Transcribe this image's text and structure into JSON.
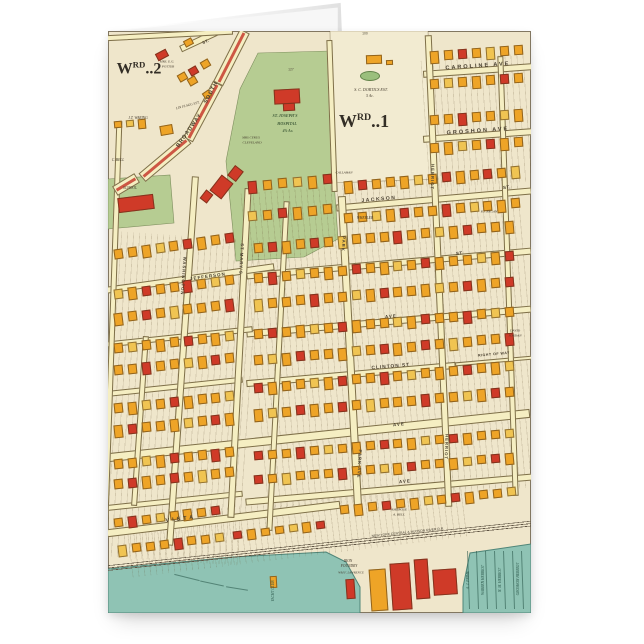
{
  "page": {
    "background": "#ffffff"
  },
  "card": {
    "description": "folded greeting card, portrait, fold at top",
    "front_print": "antique plat map"
  },
  "map": {
    "width": 423,
    "height": 582,
    "colors": {
      "base": "#efe6cb",
      "street": "#f5eec2",
      "green": "#b6cc92",
      "pond": "#9bbf7c",
      "water": "#8fc3b4",
      "water_edge": "#4f8578",
      "estate": "#f2ebd1",
      "broadway_stripe": "#cd5744",
      "building": {
        "o": "#eea427",
        "r": "#cf3a28",
        "y": "#f0c452"
      }
    },
    "building_palette": "ooroyooorooyoroooyor",
    "areas": [
      {
        "name": "dortics-estate",
        "points": "222,0 320,0 326,148 224,152",
        "fill": "#f2ebd1",
        "stroke": "rgba(105,88,52,.6)",
        "sw": 0.6
      },
      {
        "name": "hospital-grounds-green",
        "points": "150,22 222,20 226,150 230,208 196,226 128,230 118,130 132,58",
        "fill": "#b6cc92",
        "stroke": "rgba(90,110,60,.7)",
        "sw": 0.6
      },
      {
        "name": "school-green",
        "points": "0,148 62,144 66,192 0,198",
        "fill": "#b6cc92",
        "stroke": "rgba(90,110,60,.7)",
        "sw": 0.6
      },
      {
        "name": "river-water",
        "points": "0,538 125,526 218,521 238,531 252,556 252,582 0,582",
        "fill": "#8fc3b4",
        "stroke": "#4f8578",
        "sw": 1
      },
      {
        "name": "harbor-water",
        "points": "355,582 355,556 362,522 423,513 423,582",
        "fill": "#8fc3b4",
        "stroke": "#4f8578",
        "sw": 1
      }
    ],
    "pond": {
      "x": 252,
      "y": 40,
      "w": 18,
      "h": 8
    },
    "textures": [
      [
        317,
        26,
        106,
        128,
        -4
      ],
      [
        146,
        150,
        277,
        318,
        -5
      ],
      [
        2,
        205,
        140,
        325,
        4
      ],
      [
        20,
        468,
        340,
        58,
        -7
      ]
    ],
    "streets": [
      {
        "name": "caroline-ave",
        "x": 370,
        "y": 39,
        "l": 110,
        "t": 7,
        "r": -4
      },
      {
        "name": "groshon-ave",
        "x": 370,
        "y": 104,
        "l": 110,
        "t": 7,
        "r": -4
      },
      {
        "name": "jackson-st",
        "x": 326,
        "y": 168,
        "l": 196,
        "t": 7,
        "r": -5
      },
      {
        "name": "cross-st-1",
        "x": 281,
        "y": 232,
        "l": 286,
        "t": 7,
        "r": -5
      },
      {
        "name": "ave-1",
        "x": 281,
        "y": 290,
        "l": 286,
        "t": 7,
        "r": -5
      },
      {
        "name": "clinton-st",
        "x": 243,
        "y": 343,
        "l": 210,
        "t": 7,
        "r": -5
      },
      {
        "name": "right-of-way",
        "x": 386,
        "y": 330,
        "l": 78,
        "t": 4,
        "r": -5
      },
      {
        "name": "ave-2",
        "x": 211,
        "y": 404,
        "l": 424,
        "t": 9,
        "r": -6
      },
      {
        "name": "ave-3",
        "x": 281,
        "y": 458,
        "l": 288,
        "t": 7,
        "r": -5
      },
      {
        "name": "ave-3-west",
        "x": 65,
        "y": 470,
        "l": 140,
        "t": 6,
        "r": -6
      },
      {
        "name": "vista-ave",
        "x": 115,
        "y": 488,
        "l": 235,
        "t": 8,
        "r": -7
      },
      {
        "name": "jefferson-st",
        "x": 82,
        "y": 247,
        "l": 170,
        "t": 7,
        "r": -8
      },
      {
        "name": "west-st-1",
        "x": 70,
        "y": 306,
        "l": 150,
        "t": 6,
        "r": -6
      },
      {
        "name": "west-st-2",
        "x": 65,
        "y": 356,
        "l": 140,
        "t": 6,
        "r": -6
      },
      {
        "name": "washington-st",
        "x": 74,
        "y": 330,
        "l": 370,
        "t": 7,
        "r": 4,
        "v": 1
      },
      {
        "name": "st-marys-st",
        "x": 131,
        "y": 322,
        "l": 330,
        "t": 7,
        "r": 3,
        "v": 1
      },
      {
        "name": "park-ave",
        "x": 242,
        "y": 322,
        "l": 315,
        "t": 8,
        "r": -3,
        "v": 1
      },
      {
        "name": "herriot-st",
        "x": 330,
        "y": 240,
        "l": 472,
        "t": 7,
        "r": -2.5,
        "v": 1
      },
      {
        "name": "east-st",
        "x": 400,
        "y": 245,
        "l": 440,
        "t": 6,
        "r": -2,
        "v": 1
      },
      {
        "name": "left-edge-st",
        "x": 3,
        "y": 330,
        "l": 480,
        "t": 6,
        "r": 2,
        "v": 1
      },
      {
        "name": "mid-st",
        "x": 170,
        "y": 335,
        "l": 330,
        "t": 6,
        "r": 3,
        "v": 1
      },
      {
        "name": "west-short-st",
        "x": 32,
        "y": 390,
        "l": 170,
        "t": 6,
        "r": 4,
        "v": 1
      },
      {
        "name": "estate-west-st",
        "x": 224,
        "y": 85,
        "l": 152,
        "t": 6,
        "r": -2,
        "v": 1
      },
      {
        "name": "top-st",
        "x": 97,
        "y": 6,
        "l": 55,
        "t": 7,
        "r": -25
      },
      {
        "name": "top-edge-st",
        "x": 60,
        "y": 4,
        "l": 130,
        "t": 6,
        "r": -3
      },
      {
        "name": "broadway-1",
        "x": 123,
        "y": 26,
        "l": 59,
        "t": 11,
        "r": 117,
        "s": 1
      },
      {
        "name": "broadway-2",
        "x": 95,
        "y": 80,
        "l": 64,
        "t": 11,
        "r": 118,
        "s": 1
      },
      {
        "name": "broadway-3",
        "x": 57,
        "y": 127,
        "l": 60,
        "t": 11,
        "r": 140,
        "s": 1
      },
      {
        "name": "broadway-4",
        "x": 18,
        "y": 153,
        "l": 26,
        "t": 11,
        "r": 149,
        "s": 1
      }
    ],
    "railroad": {
      "x": 212,
      "y": 515,
      "l": 430,
      "t": 6,
      "r": -6
    },
    "building_rows": [
      [
        322,
        20,
        7,
        14,
        9,
        10,
        -4
      ],
      [
        322,
        48,
        7,
        14,
        9,
        10,
        -4
      ],
      [
        322,
        84,
        7,
        14,
        9,
        10,
        -4
      ],
      [
        322,
        112,
        7,
        14,
        9,
        10,
        -4
      ],
      [
        236,
        150,
        13,
        14,
        9,
        10,
        -5
      ],
      [
        236,
        182,
        13,
        14,
        9,
        10,
        -5
      ],
      [
        146,
        212,
        19,
        14,
        9,
        10,
        -5
      ],
      [
        146,
        242,
        19,
        14,
        9,
        10,
        -5
      ],
      [
        146,
        268,
        19,
        14,
        9,
        10,
        -5
      ],
      [
        146,
        298,
        19,
        14,
        9,
        10,
        -5
      ],
      [
        146,
        324,
        19,
        14,
        9,
        10,
        -5
      ],
      [
        146,
        352,
        19,
        14,
        9,
        10,
        -5
      ],
      [
        146,
        378,
        19,
        14,
        9,
        10,
        -5
      ],
      [
        146,
        420,
        19,
        14,
        9,
        9,
        -5
      ],
      [
        146,
        444,
        19,
        14,
        9,
        9,
        -5
      ],
      [
        232,
        474,
        13,
        14,
        9,
        9,
        -6
      ],
      [
        140,
        150,
        6,
        15,
        9,
        10,
        -5
      ],
      [
        140,
        180,
        6,
        15,
        9,
        10,
        -5
      ],
      [
        6,
        218,
        9,
        14,
        9,
        10,
        -8
      ],
      [
        6,
        258,
        9,
        14,
        9,
        10,
        -7
      ],
      [
        6,
        282,
        9,
        14,
        9,
        10,
        -7
      ],
      [
        6,
        312,
        9,
        14,
        9,
        10,
        -6
      ],
      [
        6,
        334,
        9,
        14,
        9,
        10,
        -6
      ],
      [
        6,
        372,
        9,
        14,
        9,
        10,
        -6
      ],
      [
        6,
        394,
        9,
        14,
        9,
        10,
        -6
      ],
      [
        6,
        428,
        9,
        14,
        9,
        10,
        -6
      ],
      [
        6,
        448,
        9,
        14,
        9,
        10,
        -6
      ],
      [
        6,
        487,
        8,
        14,
        9,
        9,
        -7
      ],
      [
        10,
        514,
        8,
        14,
        9,
        9,
        -7
      ],
      [
        70,
        42,
        3,
        13,
        9,
        8,
        -30
      ],
      [
        6,
        90,
        3,
        12,
        8,
        7,
        -5
      ],
      [
        125,
        500,
        7,
        14,
        9,
        8,
        -7
      ]
    ],
    "building_singles": [
      [
        48,
        20,
        12,
        8,
        -28,
        "r"
      ],
      [
        76,
        8,
        9,
        7,
        -28,
        "o"
      ],
      [
        80,
        46,
        9,
        8,
        -30,
        "o"
      ],
      [
        52,
        94,
        13,
        10,
        -10,
        "o"
      ],
      [
        95,
        60,
        8,
        7,
        -35,
        "o"
      ],
      [
        166,
        58,
        26,
        15,
        -3,
        "r"
      ],
      [
        175,
        72,
        12,
        8,
        -3,
        "r"
      ],
      [
        10,
        165,
        36,
        15,
        -7,
        "r"
      ],
      [
        106,
        146,
        15,
        20,
        38,
        "r"
      ],
      [
        122,
        136,
        11,
        13,
        38,
        "r"
      ],
      [
        94,
        160,
        9,
        11,
        38,
        "r"
      ],
      [
        258,
        24,
        16,
        9,
        -2,
        "o"
      ],
      [
        278,
        29,
        7,
        5,
        -2,
        "o"
      ],
      [
        262,
        538,
        17,
        42,
        -4,
        "o"
      ],
      [
        283,
        532,
        20,
        47,
        -4,
        "r"
      ],
      [
        307,
        528,
        14,
        40,
        -4,
        "r"
      ],
      [
        325,
        538,
        24,
        26,
        -4,
        "r"
      ],
      [
        238,
        548,
        9,
        20,
        -4,
        "r"
      ],
      [
        162,
        545,
        7,
        12,
        -3,
        "o"
      ]
    ],
    "water_lines": {
      "grid": {
        "x0": 360,
        "step": 9,
        "count": 7,
        "y": 520,
        "len": 58,
        "rot": -2
      },
      "piers": [
        [
          66,
          546,
          26,
          14
        ],
        [
          92,
          552,
          24,
          12
        ],
        [
          118,
          557,
          22,
          9
        ]
      ]
    },
    "water_names": [
      {
        "text": "A. J. PRIME",
        "x": 361,
        "y": 549
      },
      {
        "text": "WARREN HERRIOT",
        "x": 376,
        "y": 549
      },
      {
        "text": "N. M. HERRIOT",
        "x": 393,
        "y": 549
      },
      {
        "text": "GROSHON HERRIOT",
        "x": 411,
        "y": 548
      },
      {
        "text": "YACHT CLUB",
        "x": 166,
        "y": 560
      }
    ],
    "labels": [
      {
        "t": "CAROLINE  AVE",
        "x": 370,
        "y": 36,
        "s": 5.5,
        "r": -4,
        "ls": 2,
        "k": "street"
      },
      {
        "t": "GROSHON  AVE",
        "x": 370,
        "y": 101,
        "s": 5.5,
        "r": -4,
        "ls": 2,
        "k": "street"
      },
      {
        "t": "JACKSON",
        "x": 271,
        "y": 169,
        "s": 5,
        "r": -5,
        "ls": 1.5,
        "k": "street"
      },
      {
        "t": "ST.",
        "x": 399,
        "y": 157,
        "s": 4.5,
        "r": -5,
        "ls": 0.5,
        "k": "street"
      },
      {
        "t": "ST.",
        "x": 352,
        "y": 223,
        "s": 4.5,
        "r": -5,
        "ls": 0.5,
        "k": "street"
      },
      {
        "t": "AVE",
        "x": 283,
        "y": 286,
        "s": 4.5,
        "r": -5,
        "ls": 1,
        "k": "street"
      },
      {
        "t": "CLINTON  ST",
        "x": 283,
        "y": 337,
        "s": 4.8,
        "r": -5,
        "ls": 1,
        "k": "street"
      },
      {
        "t": "RIGHT OF WAY",
        "x": 386,
        "y": 324,
        "s": 3.6,
        "r": -5,
        "ls": 0.5,
        "k": "street"
      },
      {
        "t": "AVE",
        "x": 291,
        "y": 394,
        "s": 4.5,
        "r": -6,
        "ls": 1,
        "k": "street"
      },
      {
        "t": "AVE",
        "x": 297,
        "y": 451,
        "s": 4.5,
        "r": -5,
        "ls": 1,
        "k": "street"
      },
      {
        "t": "VISTA",
        "x": 73,
        "y": 489,
        "s": 5.5,
        "r": -7,
        "ls": 3,
        "k": "street"
      },
      {
        "t": "JEFFERSON",
        "x": 100,
        "y": 246,
        "s": 4.5,
        "r": -8,
        "ls": 1,
        "k": "street"
      },
      {
        "t": "SOUTH",
        "x": 104,
        "y": 62,
        "s": 5.5,
        "r": -62,
        "ls": 1,
        "k": "street"
      },
      {
        "t": "BROADWAY",
        "x": 82,
        "y": 100,
        "s": 5.5,
        "r": -55,
        "ls": 1,
        "k": "street"
      },
      {
        "t": "ST.",
        "x": 98,
        "y": 11,
        "s": 4.2,
        "r": -22,
        "ls": 0.5,
        "k": "street"
      },
      {
        "t": "WASHINGTON",
        "x": 75,
        "y": 245,
        "s": 4.2,
        "r": 94,
        "ls": 1,
        "k": "street"
      },
      {
        "t": "ST MARY'S",
        "x": 133,
        "y": 228,
        "s": 4.2,
        "r": 93,
        "ls": 1,
        "k": "street"
      },
      {
        "t": "PARK",
        "x": 235,
        "y": 213,
        "s": 4.2,
        "r": 93,
        "ls": 1,
        "k": "street"
      },
      {
        "t": "PARK  AVE",
        "x": 251,
        "y": 433,
        "s": 4.2,
        "r": 93,
        "ls": 1,
        "k": "street"
      },
      {
        "t": "HERRIOT",
        "x": 324,
        "y": 146,
        "s": 4.2,
        "r": 92,
        "ls": 1,
        "k": "street"
      },
      {
        "t": "HERRIOT",
        "x": 338,
        "y": 416,
        "s": 4.2,
        "r": 92,
        "ls": 1,
        "k": "street"
      },
      {
        "t": "W",
        "sup": "RD",
        "tail": "..2",
        "x": 31,
        "y": 38,
        "s": 16,
        "r": 0,
        "k": "ward"
      },
      {
        "t": "W",
        "sup": "RD",
        "tail": "..1",
        "x": 256,
        "y": 90,
        "s": 18,
        "r": 0,
        "k": "ward"
      },
      {
        "t": "ST. JOSEPH'S",
        "x": 177,
        "y": 85,
        "s": 4,
        "r": 0,
        "k": "green"
      },
      {
        "t": "HOSPITAL",
        "x": 179,
        "y": 93,
        "s": 4,
        "r": 0,
        "k": "green"
      },
      {
        "t": "4⅞ Ac.",
        "x": 180,
        "y": 101,
        "s": 3.8,
        "r": 0,
        "k": "green"
      },
      {
        "t": "S. C. DORTICS EST.",
        "x": 263,
        "y": 59,
        "s": 4,
        "r": 0,
        "k": "owner"
      },
      {
        "t": "5 Ac.",
        "x": 262,
        "y": 66,
        "s": 3.8,
        "r": 0,
        "k": "owner"
      },
      {
        "t": "MRS. E.G.",
        "x": 59,
        "y": 31,
        "s": 3.4,
        "r": 0,
        "k": "owner"
      },
      {
        "t": "POTTER",
        "x": 60,
        "y": 36,
        "s": 3.4,
        "r": 0,
        "k": "owner"
      },
      {
        "t": "J.T. WARING",
        "x": 30,
        "y": 88,
        "s": 3.6,
        "r": 0,
        "k": "owner"
      },
      {
        "t": "LIN FLAGG EST.",
        "x": 80,
        "y": 75,
        "s": 3.4,
        "r": -15,
        "k": "owner"
      },
      {
        "t": "MRS CYRUS",
        "x": 143,
        "y": 107,
        "s": 3.4,
        "r": 0,
        "k": "owner"
      },
      {
        "t": "CLEVELAND",
        "x": 144,
        "y": 112,
        "s": 3.4,
        "r": 0,
        "k": "owner"
      },
      {
        "t": "C. BELL",
        "x": 10,
        "y": 130,
        "s": 3.6,
        "r": 0,
        "k": "owner"
      },
      {
        "t": "SCHOOL",
        "x": 22,
        "y": 158,
        "s": 3.6,
        "r": 0,
        "k": "owner"
      },
      {
        "t": "CALLAHAN",
        "x": 236,
        "y": 142,
        "s": 3.4,
        "r": 0,
        "k": "owner"
      },
      {
        "t": "WHEELER",
        "x": 257,
        "y": 188,
        "s": 3.6,
        "r": 0,
        "k": "owner"
      },
      {
        "t": "P.J. REGAN",
        "x": 381,
        "y": 181,
        "s": 3.4,
        "r": 0,
        "k": "owner"
      },
      {
        "t": "DAVID",
        "x": 407,
        "y": 300,
        "s": 3.5,
        "r": 0,
        "k": "owner"
      },
      {
        "t": "JORDAN",
        "x": 407,
        "y": 305,
        "s": 3.5,
        "r": 0,
        "k": "owner"
      },
      {
        "t": "AMBROSE",
        "x": 291,
        "y": 479,
        "s": 3.5,
        "r": 0,
        "k": "owner"
      },
      {
        "t": "A. BELL",
        "x": 291,
        "y": 484,
        "s": 3.5,
        "r": 0,
        "k": "owner"
      },
      {
        "t": "IRON",
        "x": 240,
        "y": 531,
        "s": 3.6,
        "r": 0,
        "k": "owner"
      },
      {
        "t": "FOUNDRY",
        "x": 241,
        "y": 536,
        "s": 3.6,
        "r": 0,
        "k": "owner"
      },
      {
        "t": "WM F. LAWRENCE",
        "x": 243,
        "y": 542,
        "s": 3.2,
        "r": 0,
        "k": "owner"
      },
      {
        "t": "NEW YORK CENTRAL & HUDSON RIVER R.R.",
        "x": 300,
        "y": 502,
        "s": 3.4,
        "r": -6,
        "k": "rail-lbl"
      },
      {
        "t": "100",
        "x": 257,
        "y": 3,
        "s": 3.4,
        "r": 0,
        "k": "num"
      },
      {
        "t": "127",
        "x": 183,
        "y": 39,
        "s": 3.4,
        "r": 0,
        "k": "num"
      }
    ]
  }
}
